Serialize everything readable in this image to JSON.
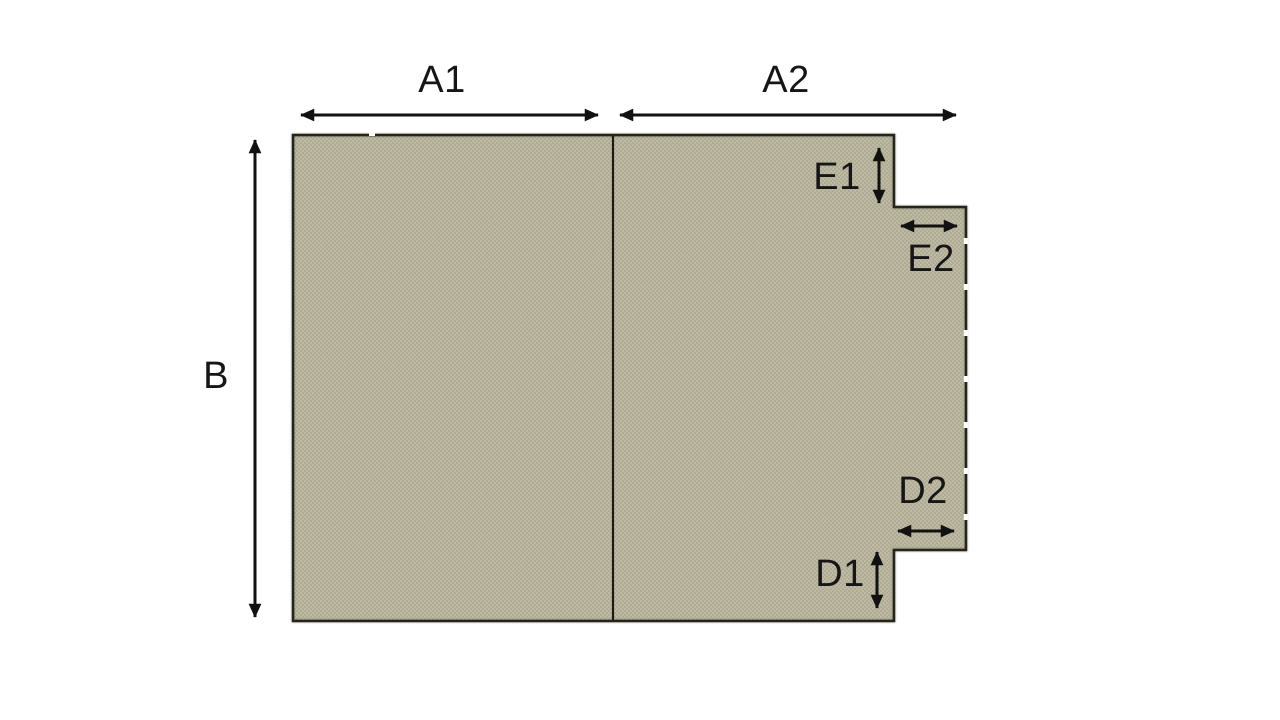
{
  "diagram": {
    "type": "dimension-diagram",
    "description": "Khaki woven fabric panel with a stepped tab on the right side and dimension arrows",
    "labels": {
      "a1": "A1",
      "a2": "A2",
      "b": "B",
      "e1": "E1",
      "e2": "E2",
      "d1": "D1",
      "d2": "D2"
    },
    "colors": {
      "fabric_base": "#b6b29a",
      "fabric_light": "#c5c1a8",
      "fabric_dark": "#a7a38a",
      "outline": "#25251c",
      "divider": "#1c1c14",
      "arrow": "#111111",
      "label_text": "#161616",
      "background": "#ffffff"
    }
  }
}
